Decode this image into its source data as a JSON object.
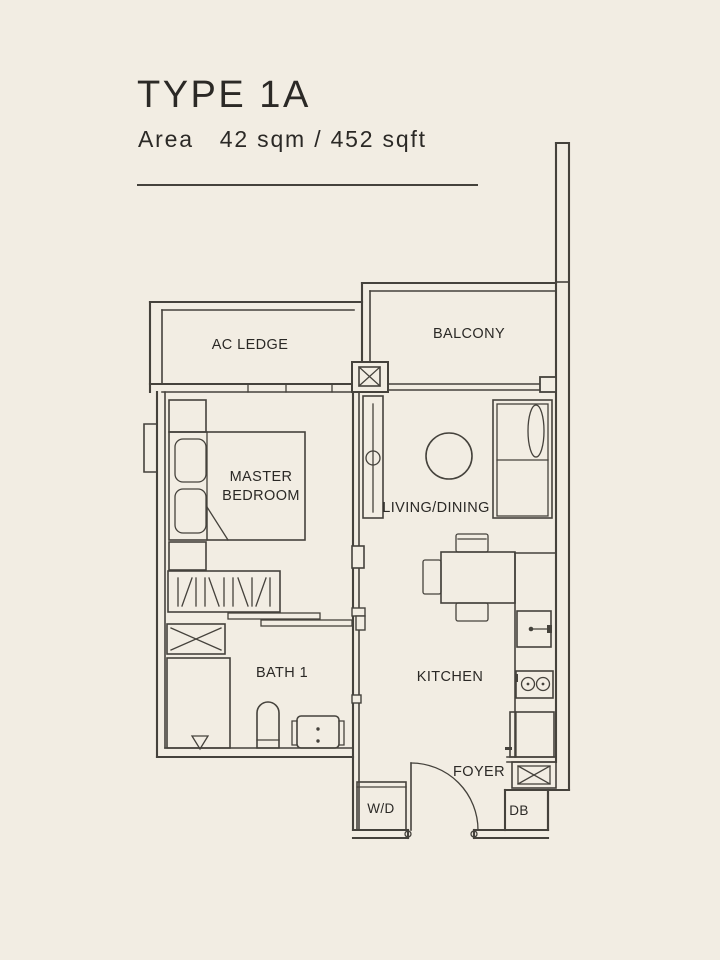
{
  "page": {
    "colors": {
      "bg": "#f2ede3",
      "line": "#45423c",
      "ink": "#2b2926"
    }
  },
  "header": {
    "title": "TYPE 1A",
    "area_label": "Area",
    "area_value": "42 sqm / 452 sqft"
  },
  "rooms": {
    "ac_ledge": {
      "label": "AC LEDGE"
    },
    "balcony": {
      "label": "BALCONY"
    },
    "master_bedroom": {
      "label_line1": "MASTER",
      "label_line2": "BEDROOM"
    },
    "living_dining": {
      "label": "LIVING/DINING"
    },
    "bath_1": {
      "label": "BATH 1"
    },
    "kitchen": {
      "label": "KITCHEN"
    },
    "foyer": {
      "label": "FOYER"
    },
    "washer_dryer": {
      "label": "W/D"
    },
    "db": {
      "label": "DB"
    }
  }
}
